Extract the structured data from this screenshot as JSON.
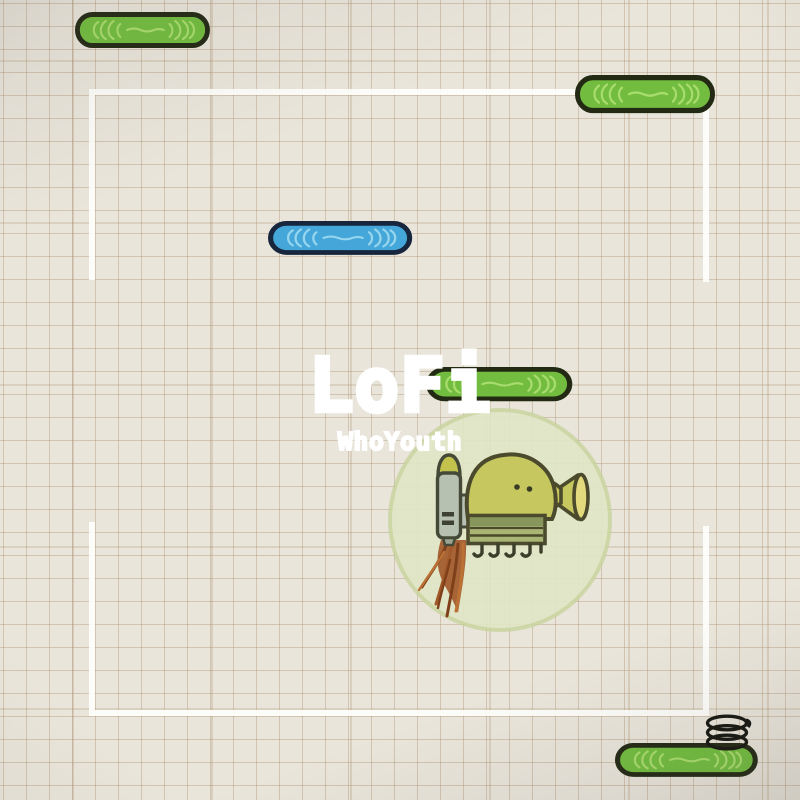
{
  "overlay": {
    "title": "LoFi",
    "subtitle": "WhoYouth",
    "text_color": "#ffffff"
  },
  "scene": {
    "style": "hand-drawn doodle-jump scene on graph paper",
    "paper_color": "#e9e5db",
    "grid_color": "#cbbda7",
    "frame_color": "#fcfcf9",
    "platform_green": "#72bd3f",
    "platform_blue": "#45a7d9",
    "outline_ink": "#232a14",
    "character": {
      "name": "doodler-with-jetpack",
      "body_color": "#c6c75e",
      "jetpack_color": "#b7c1b1",
      "flame_color": "#a2592a",
      "glow_color": "#e0e5c5"
    },
    "objects": [
      {
        "name": "green-platform",
        "x": 75,
        "y": 12,
        "w": 135,
        "h": 36
      },
      {
        "name": "green-platform",
        "x": 575,
        "y": 75,
        "w": 140,
        "h": 38
      },
      {
        "name": "blue-platform",
        "x": 268,
        "y": 221,
        "w": 144,
        "h": 34
      },
      {
        "name": "green-platform",
        "x": 426,
        "y": 367,
        "w": 146,
        "h": 34
      },
      {
        "name": "green-platform",
        "x": 615,
        "y": 743,
        "w": 143,
        "h": 34
      },
      {
        "name": "spring",
        "x": 704,
        "y": 714,
        "w": 44,
        "h": 35
      },
      {
        "name": "doodler",
        "x": 420,
        "y": 450,
        "w": 170,
        "h": 170
      }
    ]
  }
}
